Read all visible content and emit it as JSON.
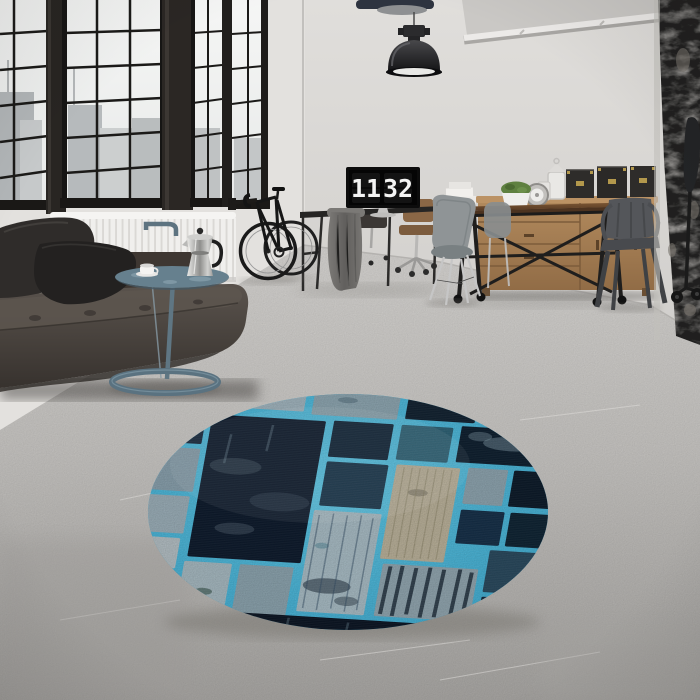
{
  "clock": {
    "hours": "11",
    "minutes": "32"
  },
  "scene": {
    "setting": "industrial loft interior, product photo of a round blue patchwork rug",
    "objects": [
      "factory-windows",
      "city-view",
      "radiator",
      "leather-sofa",
      "throw-pillows",
      "side-table",
      "moka-pot",
      "coffee-cup",
      "bicycle",
      "pendant-lamp",
      "ceiling-pipe",
      "desk",
      "monitor-flip-clock",
      "draped-jacket",
      "office-chairs",
      "molded-chair",
      "dining-table",
      "metal-armchair",
      "wood-sideboard",
      "storage-boxes",
      "lanterns",
      "potted-plant",
      "ornament-clock",
      "distressed-column",
      "tripod-lamp",
      "round-patchwork-rug",
      "concrete-floor"
    ]
  },
  "palette": {
    "wall": "#dcdad7",
    "ceiling": "#cbc9c6",
    "floor_light": "#d6d4d1",
    "floor_dark": "#a9a7a4",
    "window_frame": "#1d1b19",
    "glass": "#f0f2f1",
    "city": "#b4b8ba",
    "sofa_leather": "#46403b",
    "pillow": "#2b2927",
    "radiator": "#efeeec",
    "side_table": "#6c8290",
    "moka_silver": "#c9c9c7",
    "wood_table": "#6f4c2d",
    "wood_sideboard": "#a87f53",
    "box_black": "#2d2b29",
    "box_brass": "#b3984c",
    "chair_gray": "#8f9496",
    "chair_metal": "#54565a",
    "chrome": "#c2c2c2",
    "lamp_black": "#222224",
    "rug_lattice": "#52c1e4",
    "rug_navy": "#0e1b2d",
    "rug_light": "#abbfc8",
    "rug_beige": "#bdb49c",
    "rug_teal": "#2f6578"
  }
}
